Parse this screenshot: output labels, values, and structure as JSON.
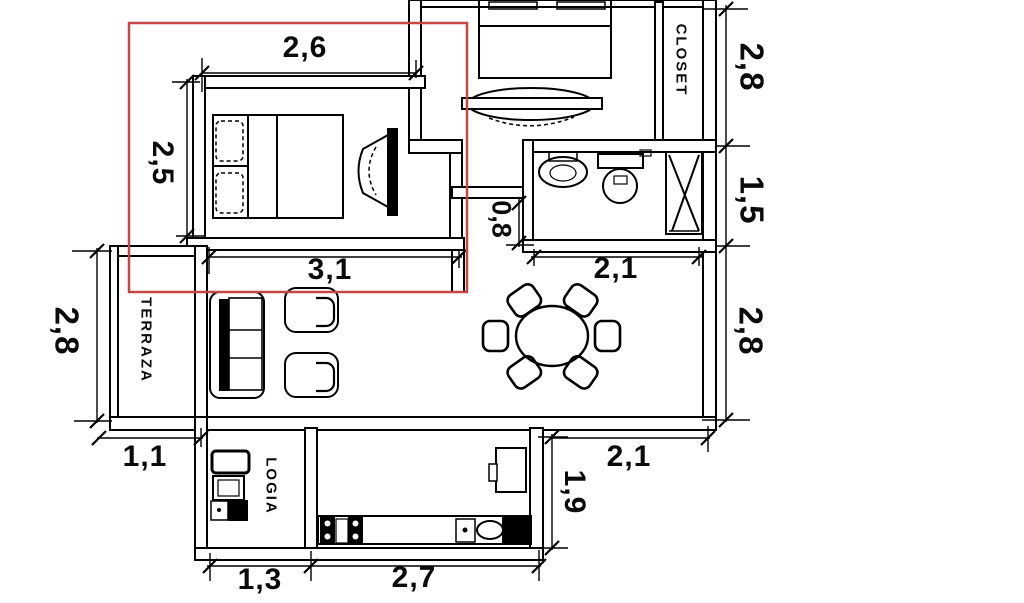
{
  "plan": {
    "background_color": "#ffffff",
    "line_color": "#000000",
    "highlight_color": "#c64545",
    "rooms": {
      "closet": "CLOSET",
      "terraza": "TERRAZA",
      "logia": "LOGIA"
    },
    "dims": {
      "bedroom_top": "2,6",
      "bedroom_left": "2,5",
      "bedroom_bottom": "3,1",
      "hall": "0,8",
      "closet_right": "2,8",
      "bath_right": "1,5",
      "dining_top": "2,1",
      "dining_right": "2,8",
      "terraza_left": "2,8",
      "terraza_bottom": "1,1",
      "logia_bottom": "1,3",
      "kitchen_bottom": "2,7",
      "kitchen_right": "1,9",
      "dining_bottom": "2,1"
    }
  }
}
